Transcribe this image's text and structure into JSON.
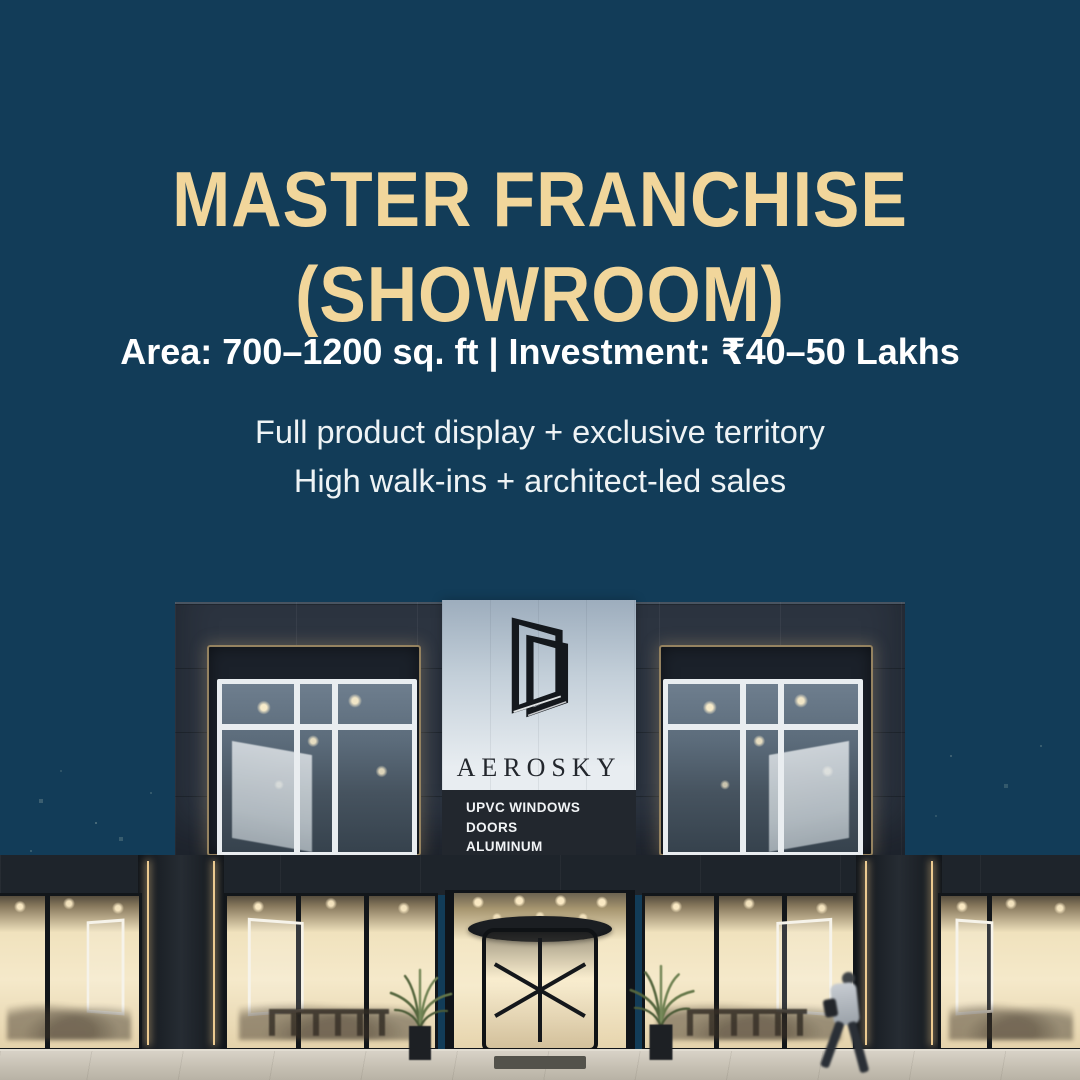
{
  "poster": {
    "background_color": "#123c58",
    "accent_color": "#f1d69b",
    "title_line1": "MASTER FRANCHISE",
    "title_line2": "(SHOWROOM)",
    "stats_line": "Area: 700–1200 sq. ft | Investment: ₹40–50 Lakhs",
    "feature_line1": "Full product display + exclusive territory",
    "feature_line2": "High walk-ins + architect-led sales"
  },
  "photo": {
    "description": "Modern two-storey AEROSKY showroom facade at dusk with lit glass storefronts, revolving entrance door, potted plants and a passerby",
    "brand": "AEROSKY",
    "sign_lines": [
      "UPVC WINDOWS",
      "DOORS",
      "ALUMINUM"
    ]
  }
}
